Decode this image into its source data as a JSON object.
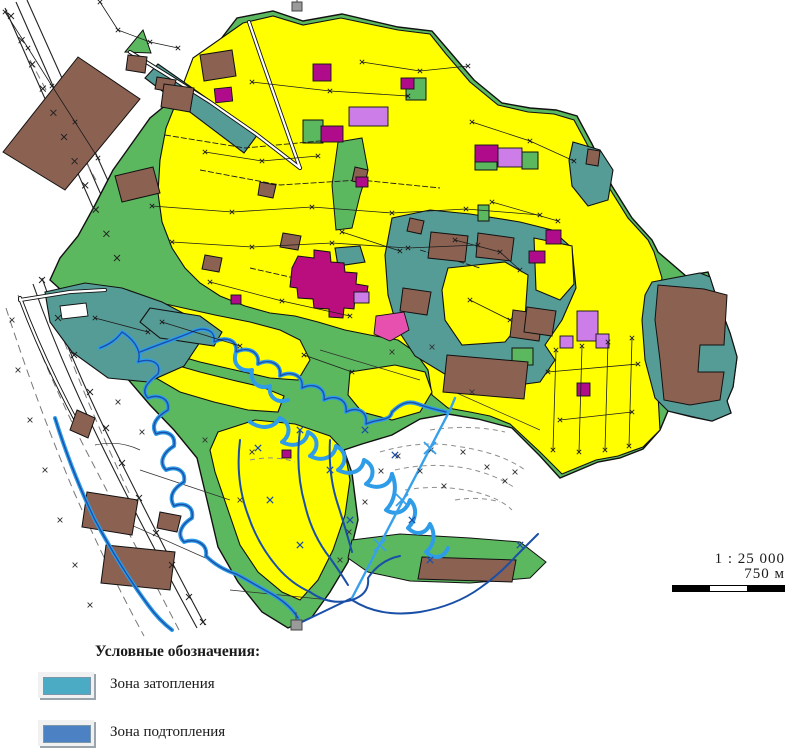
{
  "map": {
    "description": "Схема населённого пункта с зонами затопления и подтопления",
    "palette": {
      "land_green": "#5cb85f",
      "land_teal": "#569c96",
      "built_up_yellow": "#ffff00",
      "building_brown": "#8b6152",
      "zone_magenta": "#b00b8a",
      "zone_violet": "#cd7de8",
      "zone_pink": "#e850b0",
      "town_center_crimson": "#ba0d7e",
      "river_light_blue": "#2f9ce8",
      "river_dark_blue": "#1a4fa8"
    }
  },
  "scale": {
    "ratio": "1 : 25 000",
    "distance": "750 м"
  },
  "legend": {
    "title": "Условные обозначения:",
    "items": [
      {
        "label": "Зона затопления",
        "color": "#4cabc4"
      },
      {
        "label": "Зона подтопления",
        "color": "#4c82c4"
      }
    ]
  }
}
